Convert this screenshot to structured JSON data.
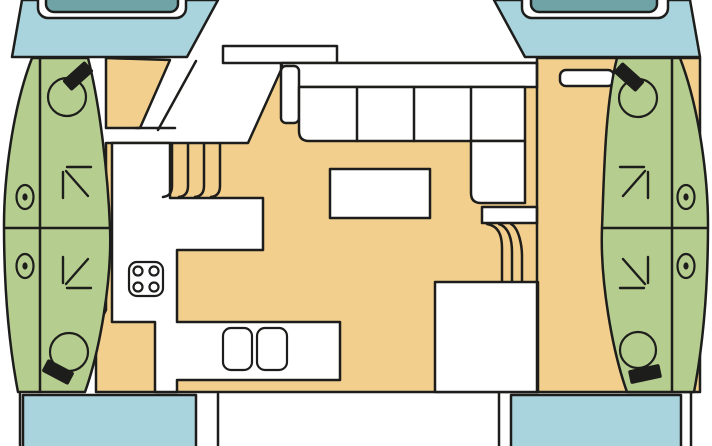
{
  "title": "catamaran-floor-plan",
  "colors": {
    "background": "#ffffff",
    "hull_cabin_green": "#b6cd90",
    "deck_floor_tan": "#f2cf8c",
    "bow_stern_blue": "#a9d3dd",
    "hatch_teal": "#6fa3a6",
    "furniture_white": "#ffffff",
    "outline": "#1d1d1b"
  },
  "plan": {
    "vessel_type": "catamaran",
    "hulls": {
      "port": {
        "forward_cabin": {
          "features": [
            "toilet",
            "double-berth-arrow",
            "porthole"
          ]
        },
        "aft_cabin": {
          "features": [
            "toilet",
            "double-berth-arrow",
            "porthole"
          ]
        }
      },
      "starboard": {
        "forward_cabin": {
          "features": [
            "toilet",
            "double-berth-arrow",
            "porthole"
          ]
        },
        "aft_cabin": {
          "features": [
            "toilet",
            "double-berth-arrow",
            "porthole"
          ]
        }
      }
    },
    "saloon": {
      "features": [
        "l-shaped-settee",
        "table",
        "companionway-stairs"
      ]
    },
    "galley": {
      "features": [
        "four-burner-stove",
        "double-sink",
        "l-shaped-counter"
      ]
    },
    "deck": {
      "features": [
        "bow-hatch-port",
        "bow-hatch-starboard",
        "stern-platform-port",
        "stern-platform-starboard",
        "forward-seat"
      ]
    },
    "counts": {
      "toilets": 4,
      "berth_arrows": 4,
      "portholes": 4,
      "stove_burners": 4,
      "sinks": 2,
      "settee_sections": 5,
      "stair_flights": 2,
      "bow_hatches": 2,
      "stern_platforms": 2
    }
  }
}
